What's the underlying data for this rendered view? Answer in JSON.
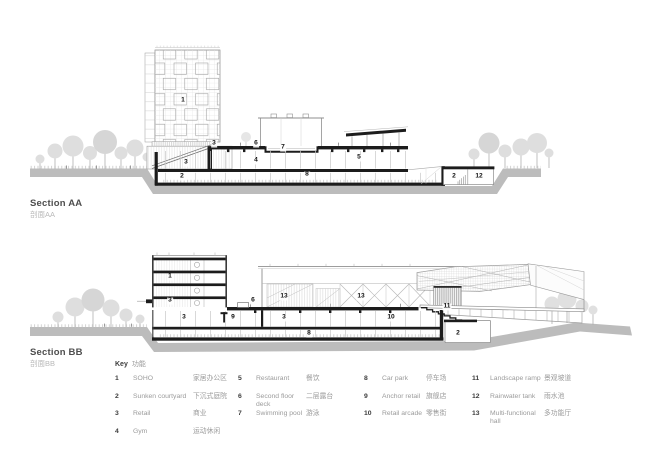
{
  "page": {
    "background": "#ffffff"
  },
  "colors": {
    "ground": "#bcbcbc",
    "ink": "#1c1c1c",
    "tree": "#dedede"
  },
  "sections": [
    {
      "id": "section-aa",
      "title": "Section AA",
      "subtitle": "剖面AA",
      "markers": [
        {
          "label": "1",
          "x": 183,
          "y": 101
        },
        {
          "label": "3",
          "x": 214,
          "y": 144
        },
        {
          "label": "6",
          "x": 256,
          "y": 144
        },
        {
          "label": "7",
          "x": 283,
          "y": 148
        },
        {
          "label": "4",
          "x": 256,
          "y": 161
        },
        {
          "label": "5",
          "x": 359,
          "y": 158
        },
        {
          "label": "3",
          "x": 186,
          "y": 163
        },
        {
          "label": "2",
          "x": 182,
          "y": 177
        },
        {
          "label": "8",
          "x": 307,
          "y": 175
        },
        {
          "label": "2",
          "x": 454,
          "y": 177
        },
        {
          "label": "12",
          "x": 479,
          "y": 177
        }
      ]
    },
    {
      "id": "section-bb",
      "title": "Section BB",
      "subtitle": "剖面BB",
      "markers": [
        {
          "label": "1",
          "x": 170,
          "y": 277
        },
        {
          "label": "3",
          "x": 170,
          "y": 301
        },
        {
          "label": "6",
          "x": 253,
          "y": 301
        },
        {
          "label": "13",
          "x": 284,
          "y": 297
        },
        {
          "label": "13",
          "x": 361,
          "y": 297
        },
        {
          "label": "9",
          "x": 233,
          "y": 318
        },
        {
          "label": "3",
          "x": 184,
          "y": 318
        },
        {
          "label": "3",
          "x": 284,
          "y": 318
        },
        {
          "label": "10",
          "x": 391,
          "y": 318
        },
        {
          "label": "8",
          "x": 309,
          "y": 334
        },
        {
          "label": "11",
          "x": 447,
          "y": 307
        },
        {
          "label": "2",
          "x": 458,
          "y": 334
        }
      ]
    }
  ],
  "key": {
    "title": "Key",
    "title_zh": "功能",
    "columns": [
      {
        "items": [
          {
            "num": "1",
            "en": "SOHO",
            "zh": "家居办公区"
          },
          {
            "num": "2",
            "en": "Sunken courtyard",
            "zh": "下沉式庭院"
          },
          {
            "num": "3",
            "en": "Retail",
            "zh": "商业"
          },
          {
            "num": "4",
            "en": "Gym",
            "zh": "运动休闲"
          }
        ]
      },
      {
        "items": [
          {
            "num": "5",
            "en": "Restaurant",
            "zh": "餐饮"
          },
          {
            "num": "6",
            "en": "Second floor deck",
            "zh": "二层露台"
          },
          {
            "num": "7",
            "en": "Swimming pool",
            "zh": "游泳"
          }
        ]
      },
      {
        "items": [
          {
            "num": "8",
            "en": "Car park",
            "zh": "停车场"
          },
          {
            "num": "9",
            "en": "Anchor retail",
            "zh": "旗舰店"
          },
          {
            "num": "10",
            "en": "Retail arcade",
            "zh": "零售街"
          }
        ]
      },
      {
        "items": [
          {
            "num": "11",
            "en": "Landscape ramp",
            "zh": "景观坡道"
          },
          {
            "num": "12",
            "en": "Rainwater tank",
            "zh": "雨水池"
          },
          {
            "num": "13",
            "en": "Multi-functional hall",
            "zh": "多功能厅"
          }
        ]
      }
    ]
  }
}
